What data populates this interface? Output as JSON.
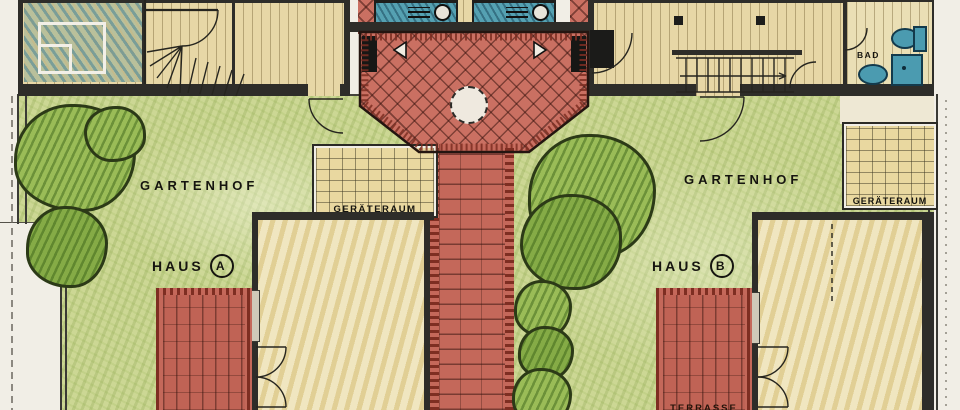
{
  "plan": {
    "areas": {
      "gartenhof_left": "GARTENHOF",
      "gartenhof_right": "GARTENHOF",
      "geraeteraum_left": "GERÄTERAUM",
      "geraeteraum_right": "GERÄTERAUM",
      "bad": "BAD",
      "terrasse_b": "TERRASSE"
    },
    "houses": {
      "haus_a_word": "HAUS",
      "haus_a_id": "A",
      "haus_b_word": "HAUS",
      "haus_b_id": "B"
    },
    "colors": {
      "paper": "#f1eee6",
      "lawn": "#ccd794",
      "tree_green": "#9abc57",
      "brick_red": "#ca7062",
      "brick_dark": "#7e2e22",
      "floor_tan": "#e7d7a6",
      "shed_tan": "#e9d8a0",
      "fixture_teal": "#4b9bb0",
      "wall_ink": "#2e2d29"
    }
  }
}
